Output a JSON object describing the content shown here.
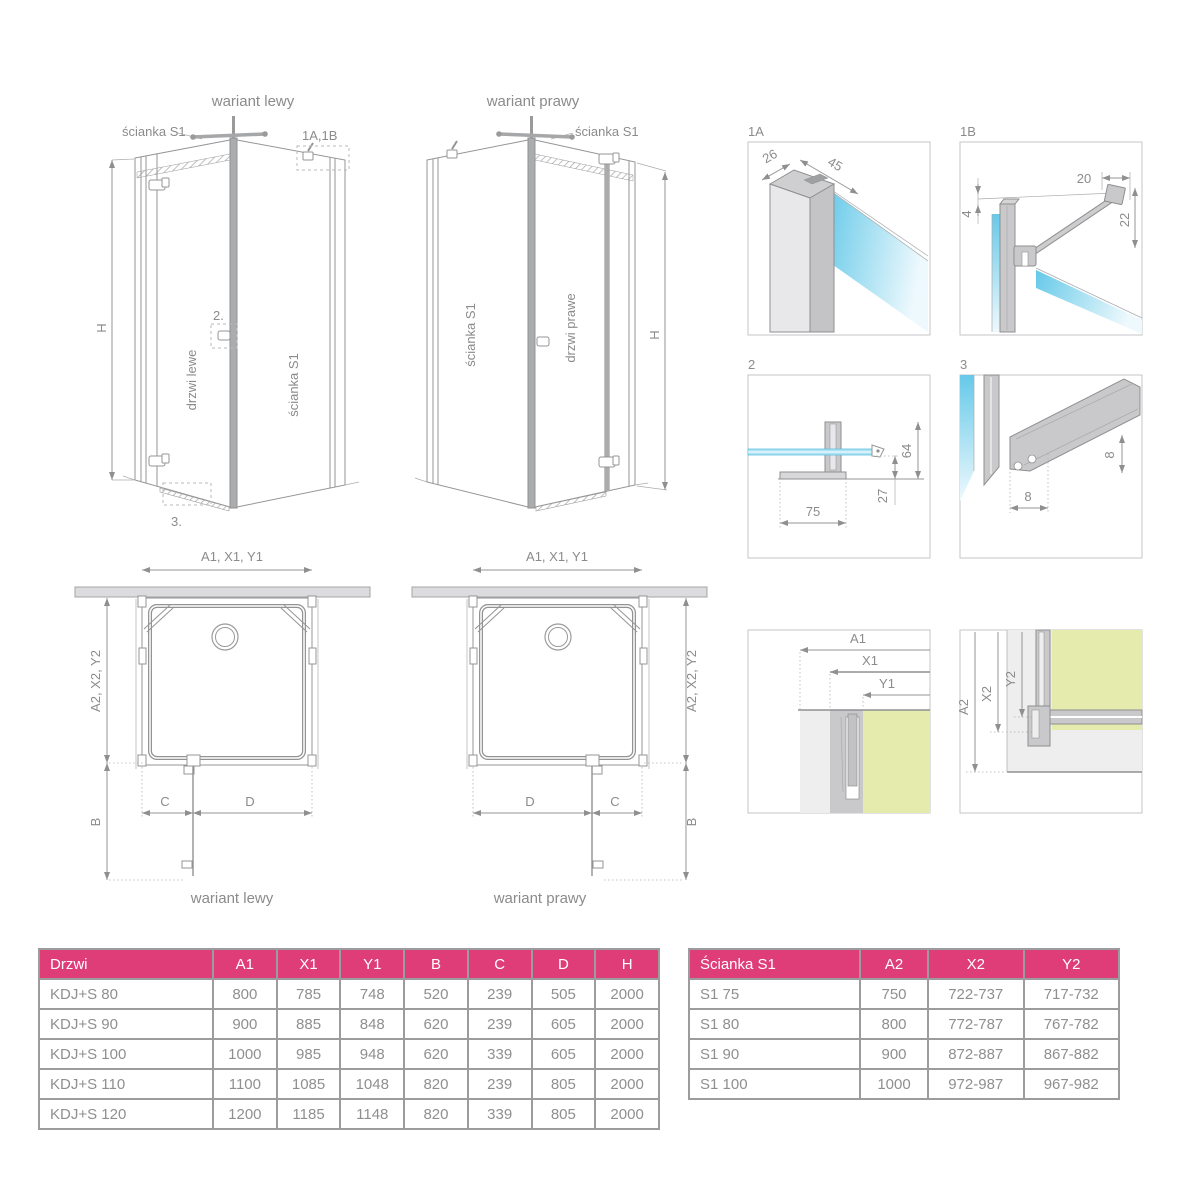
{
  "colors": {
    "header_pink": "#de3d77",
    "line_gray": "#949597",
    "text_gray": "#8b8b8b",
    "glass_blue": "#66c9e9",
    "glass_green": "#e4ebac",
    "profile_gray": "#c9c9cb",
    "wall_gray": "#eeeeef"
  },
  "views3d": {
    "left": {
      "title": "wariant lewy",
      "wall_label": "ścianka S1",
      "door_label": "drzwi lewe",
      "side_label": "ścianka S1",
      "ref_top": "1A,1B",
      "ref_handle": "2.",
      "ref_seal": "3.",
      "height": "H"
    },
    "right": {
      "title": "wariant prawy",
      "wall_label": "ścianka S1",
      "door_label": "drzwi prawe",
      "side_label": "ścianka S1",
      "height": "H"
    }
  },
  "plans": {
    "left": {
      "width_dim": "A1, X1, Y1",
      "depth_dim": "A2, X2, Y2",
      "entry_dim": "B",
      "c": "C",
      "d": "D",
      "caption": "wariant lewy"
    },
    "right": {
      "width_dim": "A1, X1, Y1",
      "depth_dim": "A2, X2, Y2",
      "entry_dim": "B",
      "c": "C",
      "d": "D",
      "caption": "wariant prawy"
    }
  },
  "details": {
    "d1a": {
      "label": "1A",
      "dim_depth": "26",
      "dim_width": "45"
    },
    "d1b": {
      "label": "1B",
      "dim_top": "20",
      "dim_gap": "4",
      "dim_side": "22"
    },
    "d2": {
      "label": "2",
      "dim_height": "64",
      "dim_clear": "27",
      "dim_base": "75"
    },
    "d3": {
      "label": "3",
      "dim_h": "8",
      "dim_w": "8"
    },
    "corner_h": {
      "a": "A1",
      "x": "X1",
      "y": "Y1"
    },
    "corner_v": {
      "a": "A2",
      "x": "X2",
      "y": "Y2"
    }
  },
  "tables": {
    "doors": {
      "headers": [
        "Drzwi",
        "A1",
        "X1",
        "Y1",
        "B",
        "C",
        "D",
        "H"
      ],
      "rows": [
        [
          "KDJ+S 80",
          "800",
          "785",
          "748",
          "520",
          "239",
          "505",
          "2000"
        ],
        [
          "KDJ+S 90",
          "900",
          "885",
          "848",
          "620",
          "239",
          "605",
          "2000"
        ],
        [
          "KDJ+S 100",
          "1000",
          "985",
          "948",
          "620",
          "339",
          "605",
          "2000"
        ],
        [
          "KDJ+S 110",
          "1100",
          "1085",
          "1048",
          "820",
          "239",
          "805",
          "2000"
        ],
        [
          "KDJ+S 120",
          "1200",
          "1185",
          "1148",
          "820",
          "339",
          "805",
          "2000"
        ]
      ]
    },
    "walls": {
      "headers": [
        "Ścianka S1",
        "A2",
        "X2",
        "Y2"
      ],
      "rows": [
        [
          "S1 75",
          "750",
          "722-737",
          "717-732"
        ],
        [
          "S1 80",
          "800",
          "772-787",
          "767-782"
        ],
        [
          "S1 90",
          "900",
          "872-887",
          "867-882"
        ],
        [
          "S1 100",
          "1000",
          "972-987",
          "967-982"
        ]
      ]
    }
  }
}
